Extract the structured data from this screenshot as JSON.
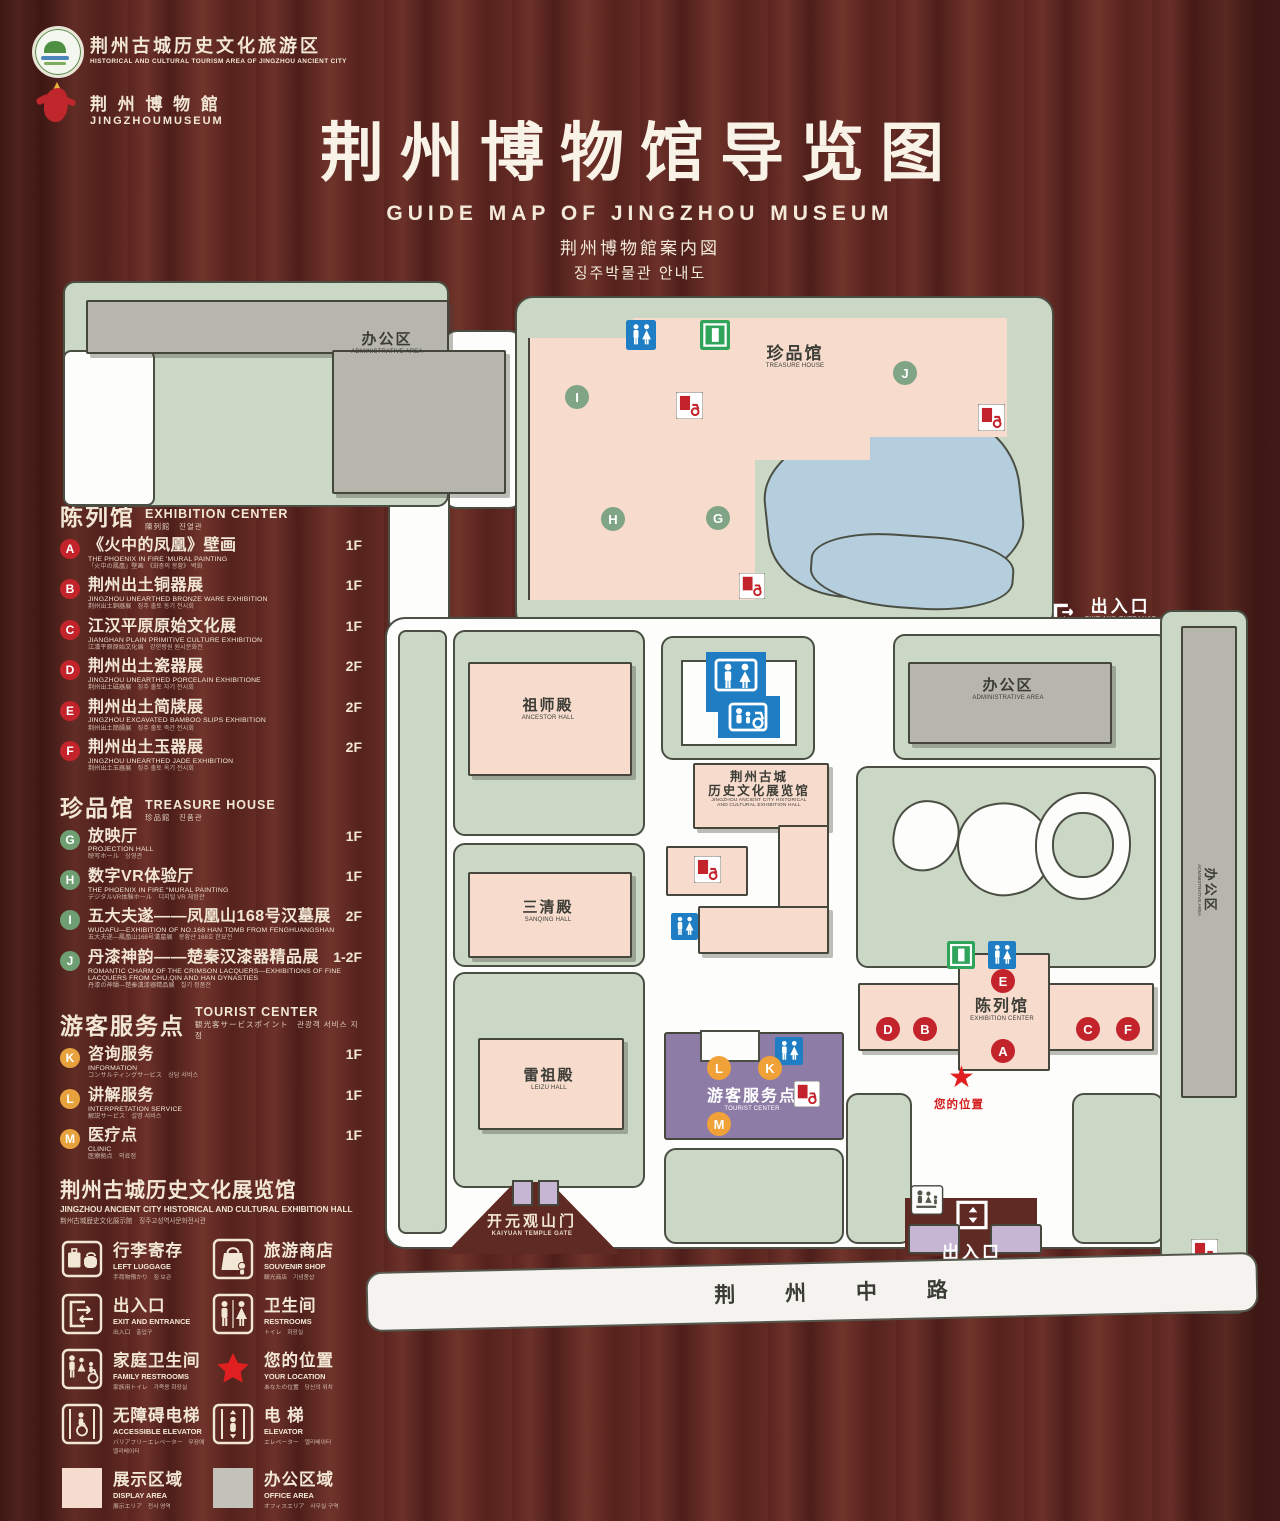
{
  "header": {
    "tourism_logo": {
      "zh": "荆州古城历史文化旅游区",
      "en": "HISTORICAL AND CULTURAL TOURISM AREA OF JINGZHOU ANCIENT CITY"
    },
    "museum_logo": {
      "zh": "荆 州 博 物 館",
      "en": "JINGZHOUMUSEUM"
    },
    "title_zh": "荆州博物馆导览图",
    "title_en": "GUIDE MAP OF JINGZHOU MUSEUM",
    "title_ja": "荆州博物館案内図",
    "title_ko": "징주박물관 안내도"
  },
  "legend": {
    "sections": [
      {
        "title_zh": "陈列馆",
        "title_en": "EXHIBITION CENTER",
        "title_sub": "陳列館　진열관",
        "badge": "b-red",
        "items": [
          {
            "letter": "A",
            "zh": "《火中的凤凰》壁画",
            "en": "THE PHOENIX IN FIRE 'MURAL PAINTING",
            "sub": "「火中の鳳凰」壁画　《화중의 봉황》 벽화",
            "floor": "1F"
          },
          {
            "letter": "B",
            "zh": "荆州出土铜器展",
            "en": "JINGZHOU UNEARTHED BRONZE WARE EXHIBITION",
            "sub": "荆州出土銅器展　징주 출토 동기 전시회",
            "floor": "1F"
          },
          {
            "letter": "C",
            "zh": "江汉平原原始文化展",
            "en": "JIANGHAN PLAIN PRIMITIVE CULTURE EXHIBITION",
            "sub": "江漢平原原始文化展　강한평원 원시문화전",
            "floor": "1F"
          },
          {
            "letter": "D",
            "zh": "荆州出土瓷器展",
            "en": "JINGZHOU UNEARTHED PORCELAIN EXHIBITIONE",
            "sub": "荆州出土磁器展　징주 출토 자기 전시회",
            "floor": "2F"
          },
          {
            "letter": "E",
            "zh": "荆州出土简牍展",
            "en": "JINGZHOU EXCAVATED BAMBOO SLIPS EXHIBITION",
            "sub": "荆州出土簡牘展　징주 출토 죽간 전시회",
            "floor": "2F"
          },
          {
            "letter": "F",
            "zh": "荆州出土玉器展",
            "en": "JINGZHOU UNEARTHED JADE EXHIBITION",
            "sub": "荆州出土玉器展　징주 출토 옥기 전시회",
            "floor": "2F"
          }
        ]
      },
      {
        "title_zh": "珍品馆",
        "title_en": "TREASURE HOUSE",
        "title_sub": "珍品館　진품관",
        "badge": "b-green",
        "items": [
          {
            "letter": "G",
            "zh": "放映厅",
            "en": "PROJECTION HALL",
            "sub": "映写ホール　상영관",
            "floor": "1F"
          },
          {
            "letter": "H",
            "zh": "数字VR体验厅",
            "en": "THE PHOENIX IN FIRE \"MURAL PAINTING",
            "sub": "デジタルVR体験ホール　디지털 VR 체험관",
            "floor": "1F"
          },
          {
            "letter": "I",
            "zh": "五大夫遂——凤凰山168号汉墓展",
            "en": "WUDAFU—EXHIBITION OF NO.168 HAN TOMB FROM FENGHUANGSHAN",
            "sub": "五大夫遂—鳳凰山168号漢墓展　봉황산 168호 한묘전",
            "floor": "2F"
          },
          {
            "letter": "J",
            "zh": "丹漆神韵——楚秦汉漆器精品展",
            "en": "ROMANTIC CHARM OF THE CRIMSON LACQUERS—EXHIBITIONS OF FINE LACQUERS FROM CHU,QIN AND HAN DYNASTIES",
            "sub": "丹漆の神韻—楚秦漢漆器精品展　칠기 정품전",
            "floor": "1-2F"
          }
        ]
      },
      {
        "title_zh": "游客服务点",
        "title_en": "TOURIST CENTER",
        "title_sub": "観光客サービスポイント　관광객 서비스 지점",
        "badge": "b-orange",
        "items": [
          {
            "letter": "K",
            "zh": "咨询服务",
            "en": "INFORMATION",
            "sub": "コンサルティングサービス　상담 서비스",
            "floor": "1F"
          },
          {
            "letter": "L",
            "zh": "讲解服务",
            "en": "INTERPRETATION SERVICE",
            "sub": "解説サービス　설명 서비스",
            "floor": "1F"
          },
          {
            "letter": "M",
            "zh": "医疗点",
            "en": "CLINIC",
            "sub": "医療拠点　의료점",
            "floor": "1F"
          }
        ]
      }
    ],
    "hall_note": {
      "zh": "荆州古城历史文化展览馆",
      "en": "JINGZHOU ANCIENT CITY HISTORICAL AND CULTURAL EXHIBITION HALL",
      "sub": "荆州古城歴史文化展示館　징주고성역사문화전시관"
    },
    "symbols": [
      [
        {
          "icon": "luggage",
          "zh": "行李寄存",
          "en": "LEFT LUGGAGE",
          "sub": "手荷物預かり　짐 보관"
        },
        {
          "icon": "bag",
          "zh": "旅游商店",
          "en": "SOUVENIR SHOP",
          "sub": "観光商店　기념품샵"
        }
      ],
      [
        {
          "icon": "exit",
          "zh": "出入口",
          "en": "EXIT AND ENTRANCE",
          "sub": "出入口　출입구"
        },
        {
          "icon": "restroom",
          "zh": "卫生间",
          "en": "RESTROOMS",
          "sub": "トイレ　화장실"
        }
      ],
      [
        {
          "icon": "family",
          "zh": "家庭卫生间",
          "en": "FAMILY RESTROOMS",
          "sub": "家族用トイレ　가족용 화장실"
        },
        {
          "icon": "star",
          "zh": "您的位置",
          "en": "YOUR LOCATION",
          "sub": "あなたの位置　당신의 위치"
        }
      ],
      [
        {
          "icon": "access",
          "zh": "无障碍电梯",
          "en": "ACCESSIBLE ELEVATOR",
          "sub": "バリアフリーエレベーター　무장애 엘리베이터"
        },
        {
          "icon": "elevator",
          "zh": "电 梯",
          "en": "ELEVATOR",
          "sub": "エレベーター　엘리베이터"
        }
      ],
      [
        {
          "icon": "swatch-pink",
          "zh": "展示区域",
          "en": "DISPLAY AREA",
          "sub": "展示エリア　전시 영역"
        },
        {
          "icon": "swatch-gray",
          "zh": "办公区域",
          "en": "OFFICE AREA",
          "sub": "オフィスエリア　사무실 구역"
        }
      ]
    ]
  },
  "map": {
    "admin_area": {
      "zh": "办公区",
      "en": "ADMINISTRATIVE AREA"
    },
    "treasure_house": {
      "zh": "珍品馆",
      "en": "TREASURE HOUSE"
    },
    "ancestor_hall": {
      "zh": "祖师殿",
      "en": "ANCESTOR HALL"
    },
    "sanqing_hall": {
      "zh": "三清殿",
      "en": "SANQING HALL"
    },
    "leizu_hall": {
      "zh": "雷祖殿",
      "en": "LEIZU HALL"
    },
    "hist_hall": {
      "zh1": "荆州古城",
      "zh2": "历史文化展览馆",
      "en1": "JINGZHOU ANCIENT CITY HISTORICAL",
      "en2": "AND CULTURAL EXHIBITION HALL"
    },
    "tourist_center": {
      "zh": "游客服务点",
      "en": "TOURIST CENTER"
    },
    "exhibition_center": {
      "zh": "陈列馆",
      "en": "EXHIBITION CENTER"
    },
    "gate": {
      "zh": "开元观山门",
      "en": "KAIYUAN TEMPLE GATE"
    },
    "exit_east": {
      "zh": "出入口",
      "en": "EXIT AND ENTRANCE"
    },
    "exit_south": {
      "zh": "出入口",
      "en": "EXIT AND ENTRANCE"
    },
    "road": "荆 州 中 路",
    "your_location": "您的位置",
    "markers": [
      {
        "letter": "I",
        "type": "green"
      },
      {
        "letter": "H",
        "type": "green"
      },
      {
        "letter": "G",
        "type": "green"
      },
      {
        "letter": "J",
        "type": "green"
      },
      {
        "letter": "D",
        "type": "red"
      },
      {
        "letter": "B",
        "type": "red"
      },
      {
        "letter": "E",
        "type": "red"
      },
      {
        "letter": "A",
        "type": "red"
      },
      {
        "letter": "C",
        "type": "red"
      },
      {
        "letter": "F",
        "type": "red"
      },
      {
        "letter": "L",
        "type": "orange"
      },
      {
        "letter": "K",
        "type": "orange"
      },
      {
        "letter": "M",
        "type": "orange"
      }
    ]
  },
  "colors": {
    "red": "#c3242b",
    "green_marker": "#7fa486",
    "orange": "#f0a138",
    "restroom_blue": "#1f7dc4",
    "exit_green": "#2fa45a",
    "sage": "#cbd8c6",
    "display_pink": "#f7dcce",
    "office_gray": "#b7b6ad",
    "tourist_purple": "#8d7ca6",
    "gate_lavender": "#c6b6d4",
    "lake_blue": "#b5cedd",
    "wood": "#5e2a23",
    "cream": "#f2e7d5"
  }
}
